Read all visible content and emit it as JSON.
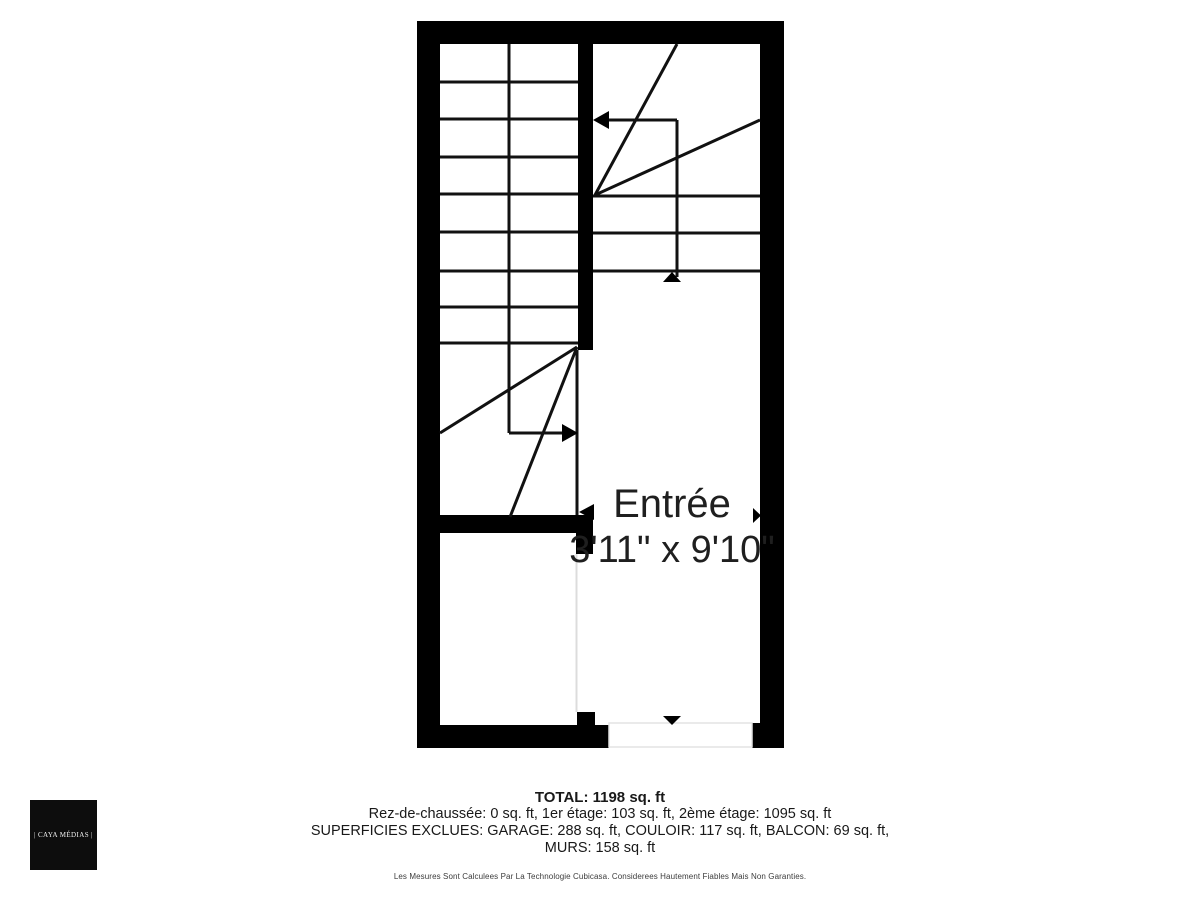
{
  "plan": {
    "room": {
      "name": "Entrée",
      "dimensions": "3'11\" x 9'10\""
    },
    "icons": {
      "stairs_left_direction": "arrow-right",
      "stairs_right_direction": "arrow-left",
      "stairs_right_start": "arrow-up",
      "entry_door": "arrow-down",
      "side_door": "arrow-right",
      "passage": "arrow-left"
    },
    "colors": {
      "wall": "#000000",
      "stair_line": "#111111",
      "room_outline": "#dcdcdc",
      "label_text": "#1f1f1f"
    }
  },
  "summary": {
    "total": "TOTAL: 1198 sq. ft",
    "floors": "Rez-de-chaussée: 0 sq. ft, 1er étage: 103 sq. ft, 2ème étage: 1095 sq. ft",
    "excluded_line1": "SUPERFICIES EXCLUES: GARAGE: 288 sq. ft, COULOIR: 117 sq. ft, BALCON: 69 sq. ft,",
    "excluded_line2": "MURS: 158 sq. ft",
    "disclaimer": "Les Mesures Sont Calculees Par La Technologie Cubicasa. Considerees Hautement Fiables Mais Non Garanties."
  },
  "logo": {
    "text": "| CAYA MÉDIAS |"
  }
}
